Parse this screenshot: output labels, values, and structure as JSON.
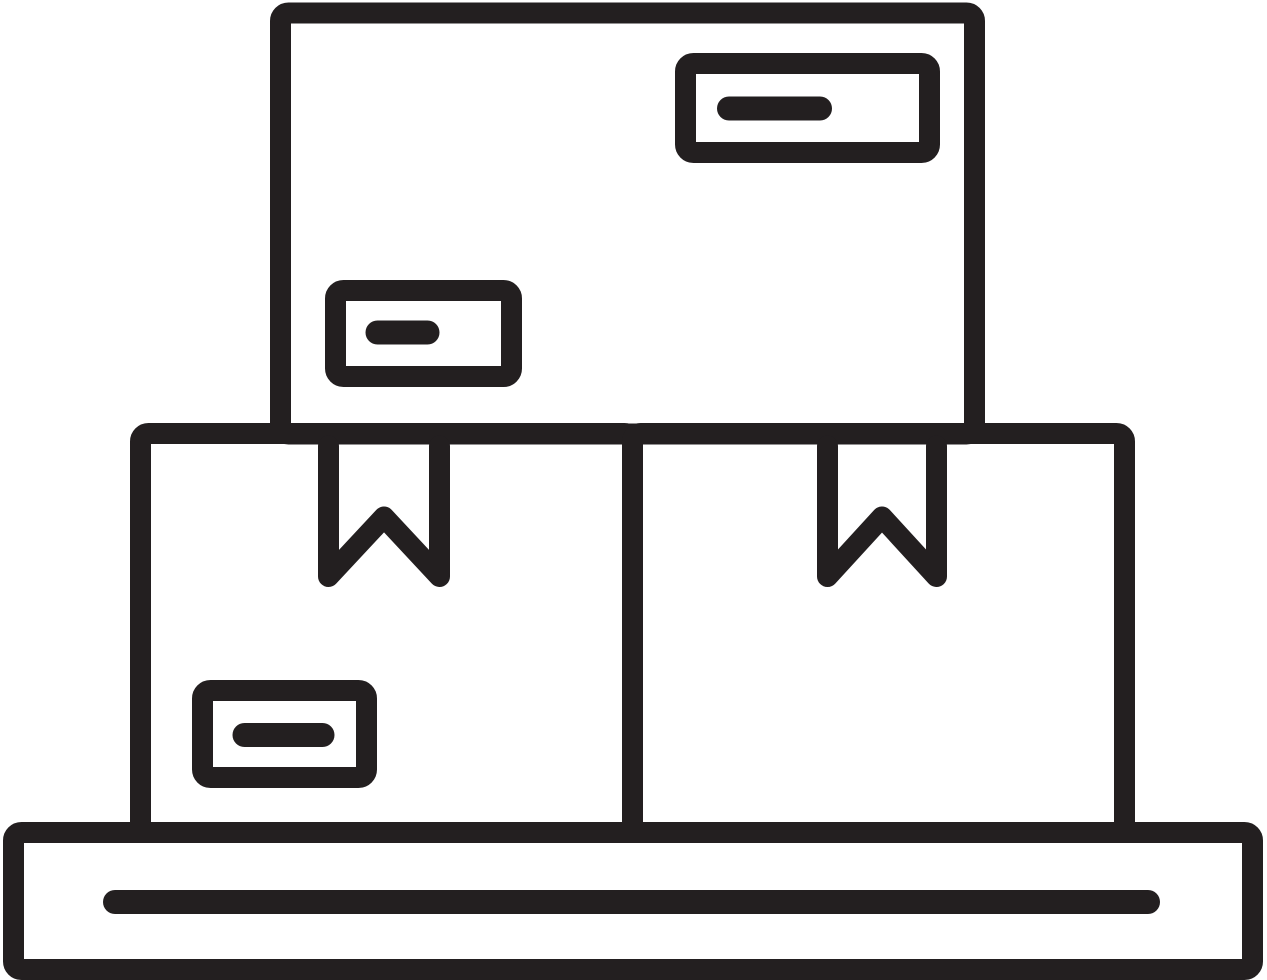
{
  "icon": {
    "title": "Delivery boxes on pallet icon",
    "description": "Black outline glyph of three cardboard shipping boxes stacked on a flat pallet: one large box on top bearing two blank address labels, and two boxes below sealed with bookmark-shaped tape ribbons, the left one bearing an address label; the pallet base has a single horizontal slat line.",
    "style": "monochrome line icon",
    "parts": [
      {
        "name": "top-box"
      },
      {
        "name": "top-box-label-right"
      },
      {
        "name": "top-box-label-right-dash"
      },
      {
        "name": "top-box-label-left"
      },
      {
        "name": "top-box-label-left-dash"
      },
      {
        "name": "bottom-left-box"
      },
      {
        "name": "bottom-right-box"
      },
      {
        "name": "bottom-left-box-tape-ribbon"
      },
      {
        "name": "bottom-right-box-tape-ribbon"
      },
      {
        "name": "bottom-left-box-label"
      },
      {
        "name": "bottom-left-box-label-dash"
      },
      {
        "name": "pallet"
      },
      {
        "name": "pallet-slat-line"
      }
    ]
  },
  "colors": {
    "line": "#231f20",
    "background": "#ffffff"
  }
}
